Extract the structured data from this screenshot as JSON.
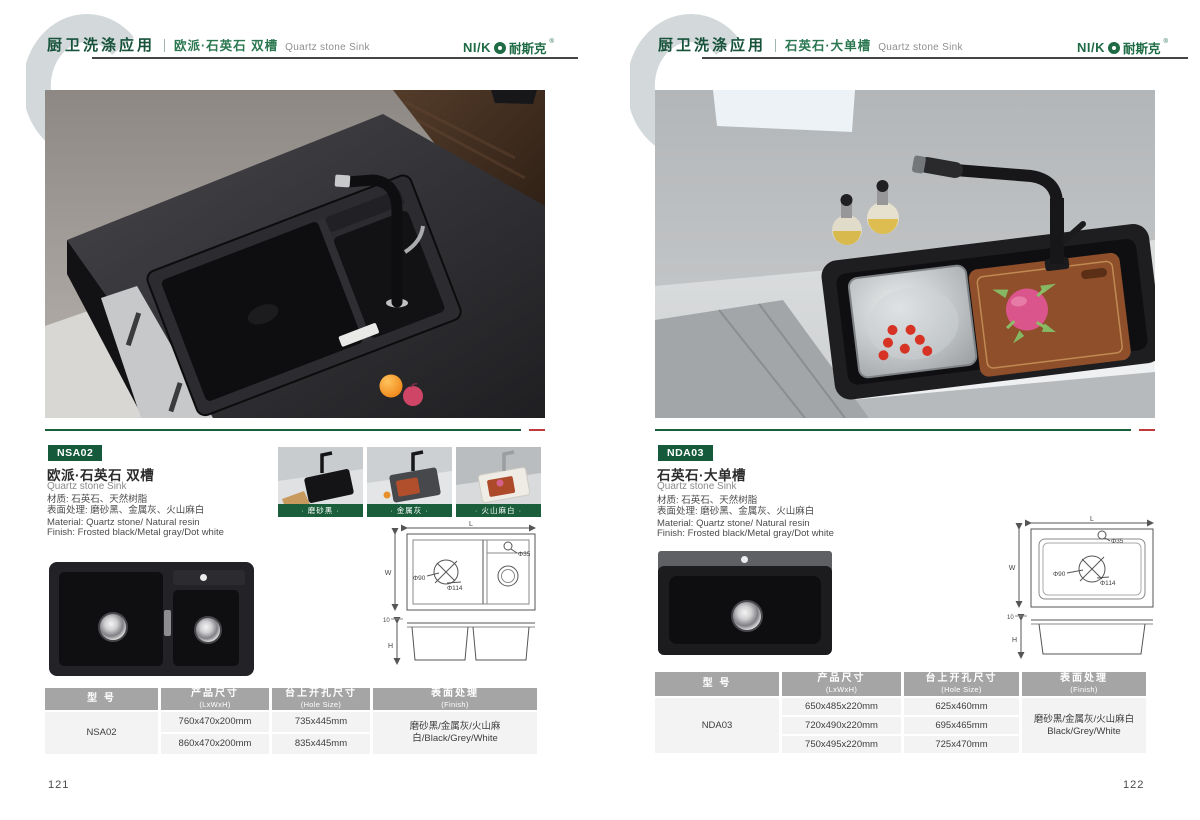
{
  "brand": {
    "latin": "NI/K",
    "cn": "耐斯克",
    "reg": "®"
  },
  "colors": {
    "brand_green": "#1b5e3b",
    "accent_red": "#bf3a3c",
    "table_header_gray": "#a5a5a5"
  },
  "pages": [
    {
      "page_number": "121",
      "header": {
        "section": "厨卫洗涤应用",
        "title_cn": "欧派·石英石 双槽",
        "title_en": "Quartz stone Sink"
      },
      "product": {
        "model": "NSA02",
        "title_cn": "欧派·石英石 双槽",
        "title_en": "Quartz stone Sink",
        "spec_cn": [
          "材质: 石英石、天然树脂",
          "表面处理: 磨砂黑、金属灰、火山麻白"
        ],
        "spec_en": [
          "Material: Quartz stone/ Natural resin",
          "Finish: Frosted black/Metal gray/Dot white"
        ]
      },
      "swatches": [
        {
          "label": "· 磨砂黑 ·"
        },
        {
          "label": "· 金属灰 ·"
        },
        {
          "label": "· 火山麻白 ·"
        }
      ],
      "drawing": {
        "length": "L",
        "width": "W",
        "hole": "Φ35",
        "drain_inner": "Φ90",
        "drain_outer": "Φ114",
        "rim": "10",
        "height": "H"
      },
      "table": {
        "headers": [
          {
            "cn": "型 号",
            "en": ""
          },
          {
            "cn": "产品尺寸",
            "en": "(LxWxH)"
          },
          {
            "cn": "台上开孔尺寸",
            "en": "(Hole Size)"
          },
          {
            "cn": "表面处理",
            "en": "(Finish)"
          }
        ],
        "model": "NSA02",
        "rows": [
          {
            "size": "760x470x200mm",
            "hole": "735x445mm"
          },
          {
            "size": "860x470x200mm",
            "hole": "835x445mm"
          }
        ],
        "finish_lines": [
          "磨砂黑/金属灰/火山麻白/Black/Grey/White"
        ]
      }
    },
    {
      "page_number": "122",
      "header": {
        "section": "厨卫洗涤应用",
        "title_cn": "石英石·大单槽",
        "title_en": "Quartz stone Sink"
      },
      "product": {
        "model": "NDA03",
        "title_cn": "石英石·大单槽",
        "title_en": "Quartz stone Sink",
        "spec_cn": [
          "材质: 石英石、天然树脂",
          "表面处理: 磨砂黑、金属灰、火山麻白"
        ],
        "spec_en": [
          "Material: Quartz stone/ Natural resin",
          "Finish: Frosted black/Metal gray/Dot white"
        ]
      },
      "drawing": {
        "length": "L",
        "width": "W",
        "hole": "Φ35",
        "drain_inner": "Φ90",
        "drain_outer": "Φ114",
        "rim": "10",
        "height": "H"
      },
      "table": {
        "headers": [
          {
            "cn": "型 号",
            "en": ""
          },
          {
            "cn": "产品尺寸",
            "en": "(LxWxH)"
          },
          {
            "cn": "台上开孔尺寸",
            "en": "(Hole Size)"
          },
          {
            "cn": "表面处理",
            "en": "(Finish)"
          }
        ],
        "model": "NDA03",
        "rows": [
          {
            "size": "650x485x220mm",
            "hole": "625x460mm"
          },
          {
            "size": "720x490x220mm",
            "hole": "695x465mm"
          },
          {
            "size": "750x495x220mm",
            "hole": "725x470mm"
          }
        ],
        "finish_lines": [
          "磨砂黑/金属灰/火山麻白",
          "Black/Grey/White"
        ]
      }
    }
  ]
}
